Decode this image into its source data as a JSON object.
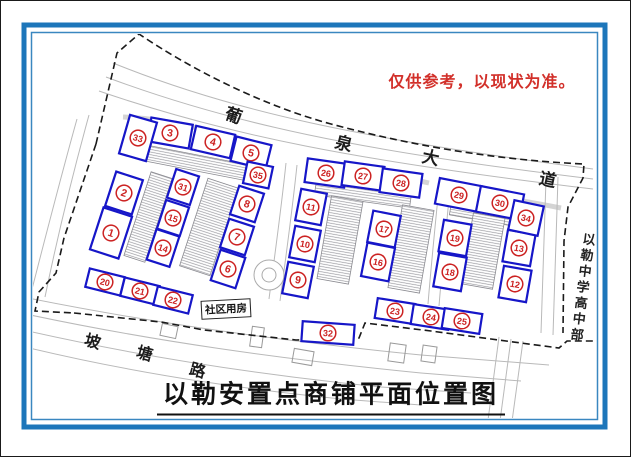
{
  "note": {
    "text": "仅供参考，以现状为准。",
    "color": "#d2302a"
  },
  "title": {
    "text": "以勒安置点商铺平面位置图"
  },
  "roads": {
    "avenue_label": {
      "name": "葡泉大道",
      "chars": [
        {
          "t": "葡",
          "x": 233,
          "y": 113,
          "r": 18,
          "s": 17
        },
        {
          "t": "泉",
          "x": 343,
          "y": 141,
          "r": 14,
          "s": 17
        },
        {
          "t": "大",
          "x": 430,
          "y": 155,
          "r": 12,
          "s": 17
        },
        {
          "t": "道",
          "x": 547,
          "y": 177,
          "r": 12,
          "s": 17
        }
      ]
    },
    "bottom_label": {
      "name": "坡塘路",
      "chars": [
        {
          "t": "坡",
          "x": 92,
          "y": 339,
          "r": 15,
          "s": 16
        },
        {
          "t": "塘",
          "x": 144,
          "y": 351,
          "r": 15,
          "s": 16
        },
        {
          "t": "路",
          "x": 197,
          "y": 368,
          "r": 15,
          "s": 16
        }
      ]
    },
    "school_label": {
      "text": "以勒中学高中部"
    },
    "community_label": {
      "text": "社区用房"
    }
  },
  "shops": [
    {
      "n": 1,
      "x": 110,
      "y": 232,
      "w": 30,
      "h": 44,
      "r": 18
    },
    {
      "n": 2,
      "x": 123,
      "y": 192,
      "w": 28,
      "h": 36,
      "r": 18
    },
    {
      "n": 3,
      "x": 169,
      "y": 132,
      "w": 42,
      "h": 24,
      "r": 10
    },
    {
      "n": 4,
      "x": 212,
      "y": 141,
      "w": 40,
      "h": 24,
      "r": 13
    },
    {
      "n": 5,
      "x": 250,
      "y": 152,
      "w": 36,
      "h": 25,
      "r": 14
    },
    {
      "n": 6,
      "x": 227,
      "y": 268,
      "w": 26,
      "h": 32,
      "r": 18
    },
    {
      "n": 7,
      "x": 236,
      "y": 236,
      "w": 26,
      "h": 30,
      "r": 18
    },
    {
      "n": 8,
      "x": 246,
      "y": 203,
      "w": 26,
      "h": 30,
      "r": 18
    },
    {
      "n": 9,
      "x": 297,
      "y": 279,
      "w": 26,
      "h": 32,
      "r": 11
    },
    {
      "n": 10,
      "x": 304,
      "y": 243,
      "w": 26,
      "h": 32,
      "r": 11
    },
    {
      "n": 11,
      "x": 310,
      "y": 206,
      "w": 26,
      "h": 32,
      "r": 11
    },
    {
      "n": 12,
      "x": 514,
      "y": 283,
      "w": 28,
      "h": 32,
      "r": 10
    },
    {
      "n": 13,
      "x": 518,
      "y": 247,
      "w": 28,
      "h": 32,
      "r": 10
    },
    {
      "n": 14,
      "x": 162,
      "y": 247,
      "w": 24,
      "h": 32,
      "r": 18
    },
    {
      "n": 15,
      "x": 172,
      "y": 217,
      "w": 24,
      "h": 30,
      "r": 18
    },
    {
      "n": 16,
      "x": 377,
      "y": 261,
      "w": 28,
      "h": 34,
      "r": 11
    },
    {
      "n": 17,
      "x": 383,
      "y": 228,
      "w": 28,
      "h": 32,
      "r": 11
    },
    {
      "n": 18,
      "x": 449,
      "y": 271,
      "w": 28,
      "h": 34,
      "r": 10
    },
    {
      "n": 19,
      "x": 454,
      "y": 237,
      "w": 28,
      "h": 32,
      "r": 10
    },
    {
      "n": 20,
      "x": 104,
      "y": 281,
      "w": 36,
      "h": 19,
      "r": 14
    },
    {
      "n": 21,
      "x": 139,
      "y": 290,
      "w": 36,
      "h": 19,
      "r": 14
    },
    {
      "n": 22,
      "x": 172,
      "y": 299,
      "w": 36,
      "h": 19,
      "r": 14
    },
    {
      "n": 23,
      "x": 394,
      "y": 310,
      "w": 38,
      "h": 20,
      "r": 9
    },
    {
      "n": 24,
      "x": 430,
      "y": 316,
      "w": 38,
      "h": 20,
      "r": 9
    },
    {
      "n": 25,
      "x": 461,
      "y": 320,
      "w": 38,
      "h": 20,
      "r": 9
    },
    {
      "n": 26,
      "x": 325,
      "y": 172,
      "w": 40,
      "h": 24,
      "r": 8
    },
    {
      "n": 27,
      "x": 362,
      "y": 175,
      "w": 40,
      "h": 24,
      "r": 8
    },
    {
      "n": 28,
      "x": 400,
      "y": 182,
      "w": 40,
      "h": 24,
      "r": 8
    },
    {
      "n": 29,
      "x": 458,
      "y": 194,
      "w": 44,
      "h": 26,
      "r": 11
    },
    {
      "n": 30,
      "x": 499,
      "y": 202,
      "w": 44,
      "h": 26,
      "r": 11
    },
    {
      "n": 31,
      "x": 182,
      "y": 186,
      "w": 24,
      "h": 30,
      "r": 18
    },
    {
      "n": 32,
      "x": 327,
      "y": 332,
      "w": 52,
      "h": 20,
      "r": 4
    },
    {
      "n": 33,
      "x": 137,
      "y": 137,
      "w": 28,
      "h": 40,
      "r": 16
    },
    {
      "n": 34,
      "x": 525,
      "y": 217,
      "w": 30,
      "h": 30,
      "r": 12
    },
    {
      "n": 35,
      "x": 257,
      "y": 174,
      "w": 26,
      "h": 22,
      "r": 12
    }
  ],
  "map": {
    "boundary": [
      "M 95 143 L 116 52 L 138 33 C 190 68 260 104 330 123 C 420 147 500 159 583 163 L 582 177 L 567 206 L 563 240 L 562 332",
      "M 95 143 L 63 237 L 55 272 L 38 291 L 34 310 L 73 312",
      "M 73 312 L 160 321 L 203 329 L 295 339 L 358 337 L 364 322 L 430 330 L 520 342 L 558 347 L 566 340 L 597 340"
    ],
    "roads": [
      "M 112 62 C 230 110 360 138 592 168",
      "M 105 76 C 228 122 358 150 592 178",
      "M 98 90 C 226 134 356 160 592 188",
      "M 76 118 C 60 175 46 230 30 292",
      "M 88 114 C 72 172 58 228 44 296",
      "M 22 296 C 150 322 280 340 420 354 L 548 364",
      "M 20 312 C 150 340 280 358 420 372 L 520 380",
      "M 18 328 C 140 356 260 374 380 386 L 470 392",
      "M 16 344 C 130 372 240 388 340 398 L 420 404",
      "M 498 336 L 482 457",
      "M 510 338 L 494 457",
      "M 522 340 L 506 457",
      "M 545 178 C 543 230 542 280 540 332",
      "M 557 176 C 555 230 554 282 552 334",
      "M 285 162 C 280 210 273 260 268 298",
      "M 296 164 C 291 212 284 262 279 300",
      "M 438 186 C 434 226 430 266 427 303",
      "M 449 188 C 445 228 441 268 438 305"
    ],
    "bands": [
      "M 122 116 C 170 118 214 130 258 148",
      "M 312 160 C 360 168 398 175 428 182",
      "M 448 187 C 492 195 530 201 560 207"
    ],
    "strips": [
      [
        196,
        162,
        106,
        16,
        11
      ],
      [
        147,
        216,
        22,
        88,
        18
      ],
      [
        208,
        226,
        32,
        92,
        18
      ],
      [
        362,
        193,
        96,
        15,
        8
      ],
      [
        339,
        239,
        32,
        84,
        10
      ],
      [
        410,
        248,
        32,
        84,
        10
      ],
      [
        481,
        213,
        64,
        13,
        10
      ],
      [
        482,
        250,
        32,
        72,
        10
      ]
    ],
    "buildings": [
      [
        168,
        330,
        16,
        12,
        12
      ],
      [
        256,
        336,
        12,
        20,
        8
      ],
      [
        302,
        356,
        20,
        14,
        10
      ],
      [
        396,
        352,
        16,
        18,
        8
      ],
      [
        428,
        353,
        14,
        16,
        8
      ]
    ],
    "roundabout": {
      "x": 268,
      "y": 274,
      "r_outer": 15,
      "r_inner": 7
    }
  },
  "colors": {
    "frame_blue": "#1d76ba",
    "frame_blue_thin": "#3a87c0",
    "shop_border_blue": "#1616c8",
    "number_red": "#cc2222",
    "road_gray": "#b9b9b9",
    "boundary_black": "#1a1a1a"
  }
}
